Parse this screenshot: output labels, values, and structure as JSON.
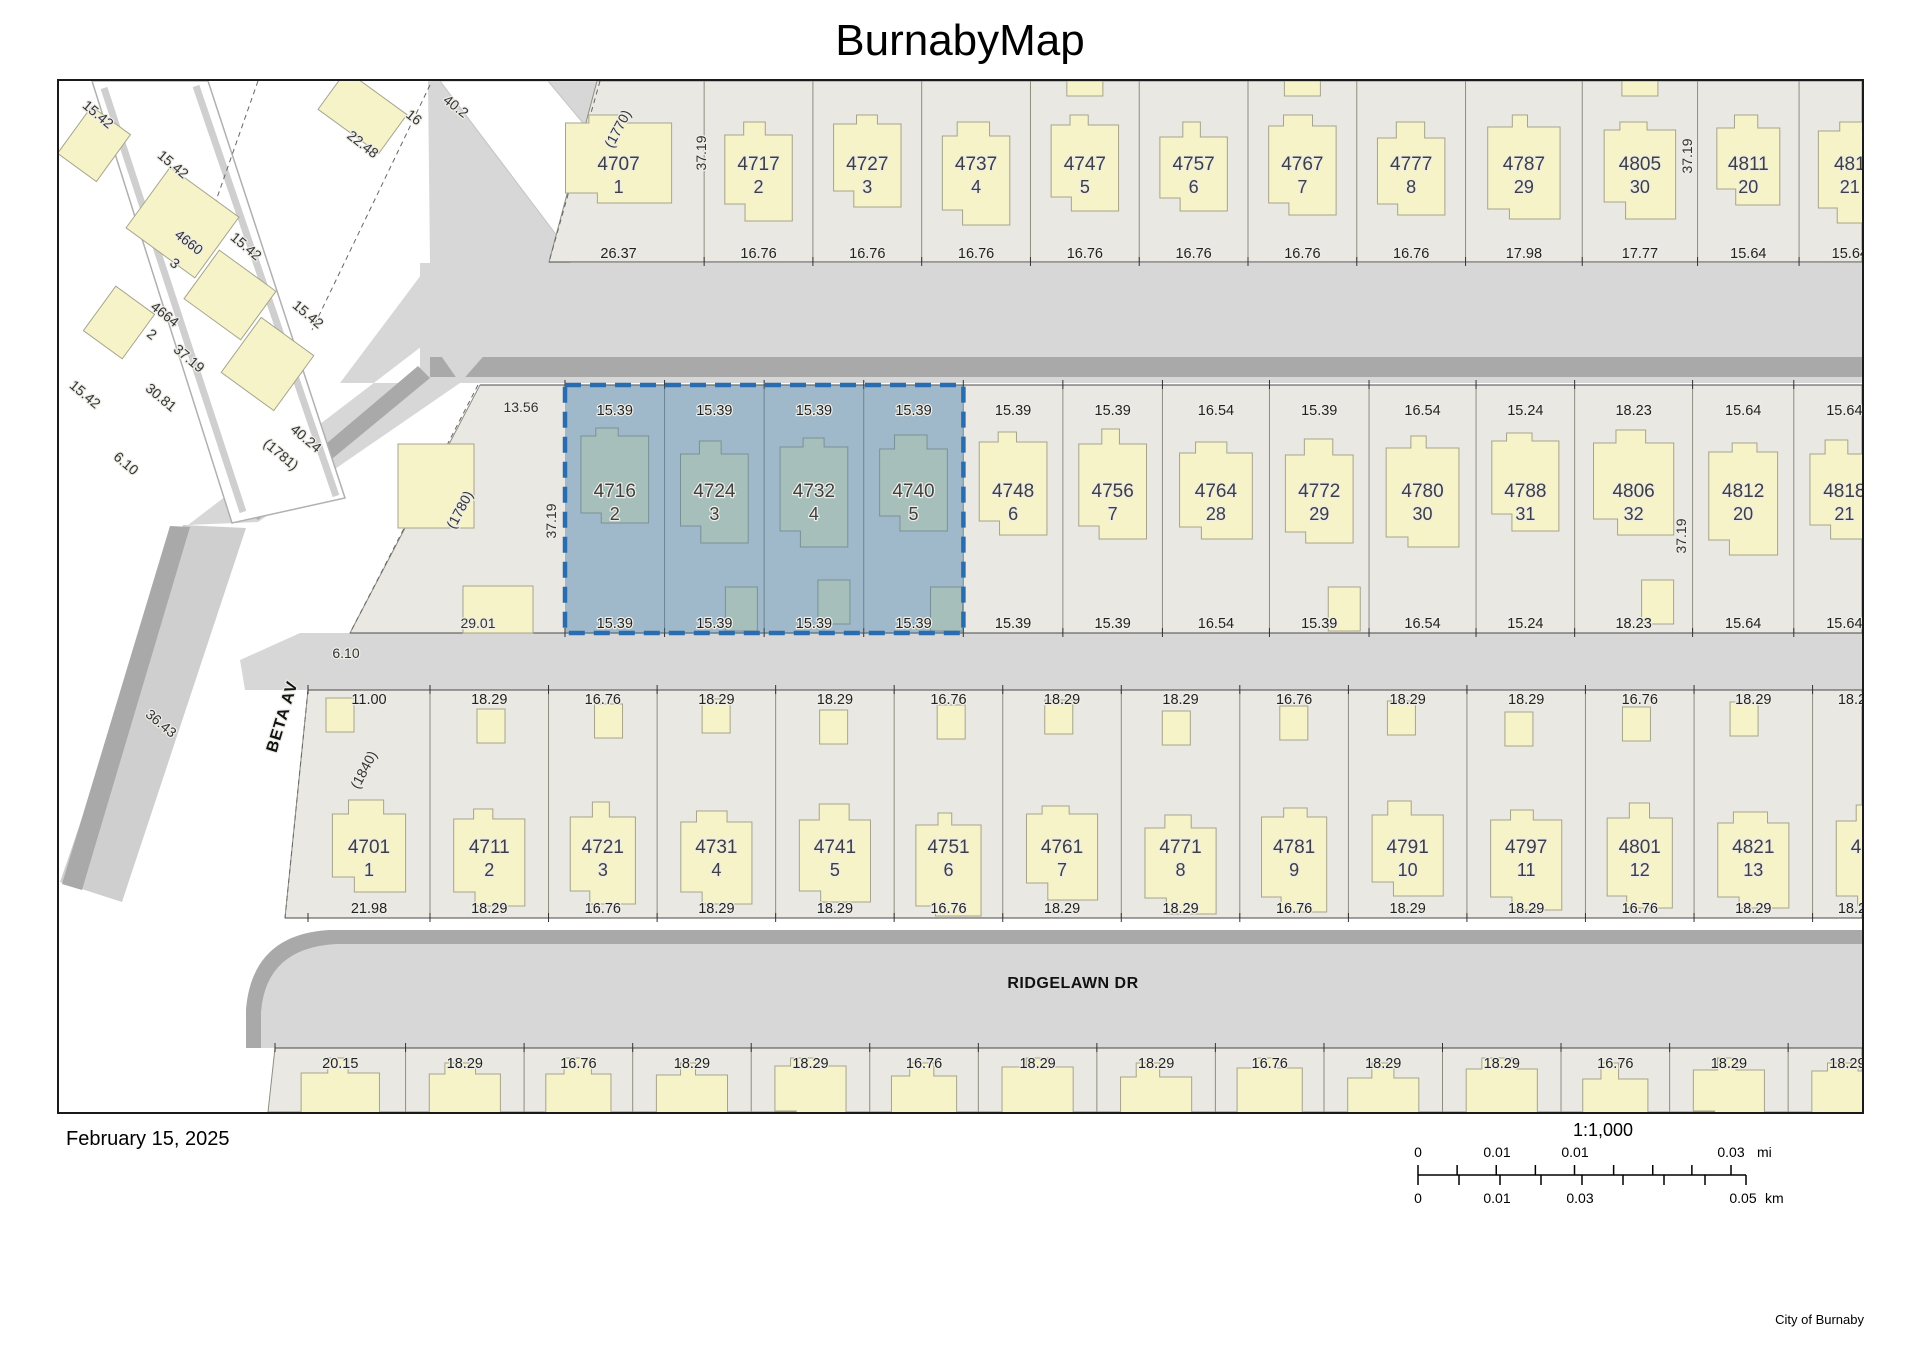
{
  "title": "BurnabyMap",
  "footer": {
    "date": "February 15, 2025",
    "attribution": "City of Burnaby"
  },
  "scalebar": {
    "ratio": "1:1,000",
    "mi": {
      "ticks": [
        "0",
        "0.01",
        "0.01",
        "0.03"
      ],
      "unit": "mi"
    },
    "km": {
      "ticks": [
        "0",
        "0.01",
        "0.03",
        "0.05"
      ],
      "unit": "km"
    }
  },
  "map": {
    "streets": [
      {
        "name": "BETA AV"
      },
      {
        "name": "RIDGELAWN DR"
      }
    ],
    "selected_parcels": [
      "4716-2",
      "4724-3",
      "4732-4",
      "4740-5"
    ],
    "colors": {
      "lot": "#eae8e2",
      "lot_line": "#8f8d80",
      "street": "#d7d7d7",
      "street_shadow": "#a9a9a9",
      "building": "#f6f3c9",
      "building_stroke": "#a6a48c",
      "selection": "#2a6cb0",
      "selection_fill": "rgba(58,118,170,0.42)",
      "dim_text": "#222222",
      "house_text": "#3f3f3f"
    },
    "rows": {
      "north": {
        "parcels": [
          {
            "house": "4707",
            "lot": "1",
            "dim": "26.37"
          },
          {
            "house": "4717",
            "lot": "2",
            "dim": "16.76"
          },
          {
            "house": "4727",
            "lot": "3",
            "dim": "16.76"
          },
          {
            "house": "4737",
            "lot": "4",
            "dim": "16.76"
          },
          {
            "house": "4747",
            "lot": "5",
            "dim": "16.76"
          },
          {
            "house": "4757",
            "lot": "6",
            "dim": "16.76"
          },
          {
            "house": "4767",
            "lot": "7",
            "dim": "16.76"
          },
          {
            "house": "4777",
            "lot": "8",
            "dim": "16.76"
          },
          {
            "house": "4787",
            "lot": "29",
            "dim": "17.98"
          },
          {
            "house": "4805",
            "lot": "30",
            "dim": "17.77"
          },
          {
            "house": "4811",
            "lot": "20",
            "dim": "15.64"
          },
          {
            "house": "481",
            "lot": "21",
            "dim": "15.64"
          }
        ]
      },
      "mid": {
        "parcels": [
          {
            "house": "4716",
            "lot": "2",
            "dim": "15.39",
            "selected": true
          },
          {
            "house": "4724",
            "lot": "3",
            "dim": "15.39",
            "selected": true
          },
          {
            "house": "4732",
            "lot": "4",
            "dim": "15.39",
            "selected": true
          },
          {
            "house": "4740",
            "lot": "5",
            "dim": "15.39",
            "selected": true
          },
          {
            "house": "4748",
            "lot": "6",
            "dim": "15.39"
          },
          {
            "house": "4756",
            "lot": "7",
            "dim": "15.39"
          },
          {
            "house": "4764",
            "lot": "28",
            "dim": "16.54"
          },
          {
            "house": "4772",
            "lot": "29",
            "dim": "15.39"
          },
          {
            "house": "4780",
            "lot": "30",
            "dim": "16.54"
          },
          {
            "house": "4788",
            "lot": "31",
            "dim": "15.24"
          },
          {
            "house": "4806",
            "lot": "32",
            "dim": "18.23"
          },
          {
            "house": "4812",
            "lot": "20",
            "dim": "15.64"
          },
          {
            "house": "4818",
            "lot": "21",
            "dim": "15.64"
          }
        ]
      },
      "south": {
        "parcels": [
          {
            "house": "4701",
            "lot": "1",
            "top_dim": "11.00",
            "bottom_dim": "21.98"
          },
          {
            "house": "4711",
            "lot": "2",
            "top_dim": "18.29",
            "bottom_dim": "18.29"
          },
          {
            "house": "4721",
            "lot": "3",
            "top_dim": "16.76",
            "bottom_dim": "16.76"
          },
          {
            "house": "4731",
            "lot": "4",
            "top_dim": "18.29",
            "bottom_dim": "18.29"
          },
          {
            "house": "4741",
            "lot": "5",
            "top_dim": "18.29",
            "bottom_dim": "18.29"
          },
          {
            "house": "4751",
            "lot": "6",
            "top_dim": "16.76",
            "bottom_dim": "16.76"
          },
          {
            "house": "4761",
            "lot": "7",
            "top_dim": "18.29",
            "bottom_dim": "18.29"
          },
          {
            "house": "4771",
            "lot": "8",
            "top_dim": "18.29",
            "bottom_dim": "18.29"
          },
          {
            "house": "4781",
            "lot": "9",
            "top_dim": "16.76",
            "bottom_dim": "16.76"
          },
          {
            "house": "4791",
            "lot": "10",
            "top_dim": "18.29",
            "bottom_dim": "18.29"
          },
          {
            "house": "4797",
            "lot": "11",
            "top_dim": "18.29",
            "bottom_dim": "18.29"
          },
          {
            "house": "4801",
            "lot": "12",
            "top_dim": "16.76",
            "bottom_dim": "16.76"
          },
          {
            "house": "4821",
            "lot": "13",
            "top_dim": "18.29",
            "bottom_dim": "18.29"
          },
          {
            "house": "4",
            "lot": "",
            "top_dim": "18.29",
            "bottom_dim": "18.29"
          }
        ]
      },
      "bottom": {
        "dims": [
          "20.15",
          "18.29",
          "16.76",
          "18.29",
          "18.29",
          "16.76",
          "18.29",
          "18.29",
          "16.76",
          "18.29",
          "18.29",
          "16.76",
          "18.29",
          "18.29"
        ]
      }
    },
    "annotations": [
      "15.42",
      "15.42",
      "15.42",
      "15.42",
      "15.42",
      "4660",
      "3",
      "4664",
      "2",
      "22.48",
      "16",
      "40.2",
      "37.19",
      "30.81",
      "40.24",
      "6.10",
      "(1781)",
      "36.43",
      "(1770)",
      "(1780)",
      "(1840)",
      "37.19",
      "37.19",
      "37.19",
      "37.19",
      "13.56",
      "29.01",
      "6.10"
    ]
  }
}
